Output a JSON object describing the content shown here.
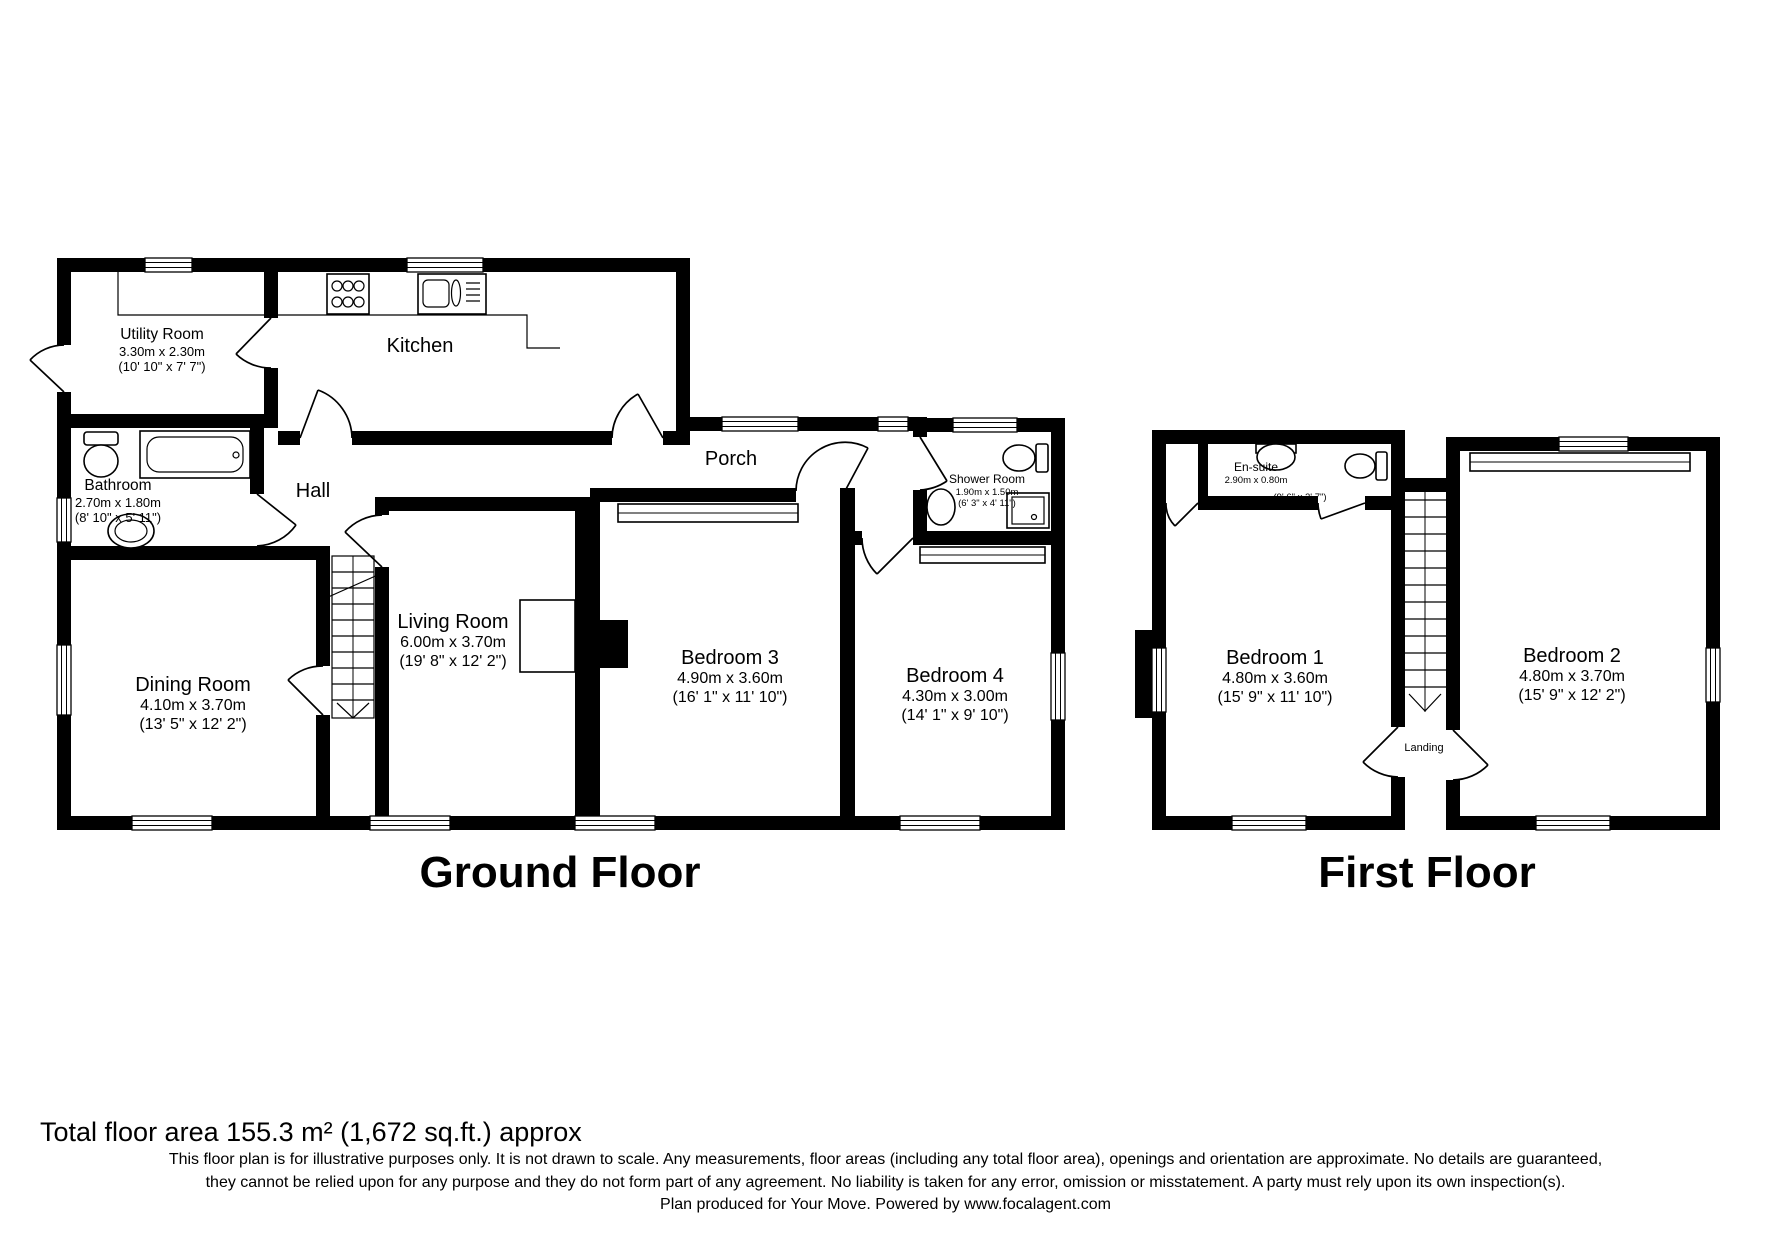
{
  "colors": {
    "wall": "#000000",
    "background": "#ffffff"
  },
  "ground_floor": {
    "title": "Ground Floor",
    "rooms": [
      {
        "name": "Utility Room",
        "dims_m": "3.30m x 2.30m",
        "dims_ft": "(10' 10\" x 7' 7\")"
      },
      {
        "name": "Kitchen"
      },
      {
        "name": "Bathroom",
        "dims_m": "2.70m x 1.80m",
        "dims_ft": "(8' 10\" x 5' 11\")"
      },
      {
        "name": "Hall"
      },
      {
        "name": "Porch"
      },
      {
        "name": "Shower Room",
        "dims_m": "1.90m x 1.50m",
        "dims_ft": "(6' 3\" x 4' 11\")"
      },
      {
        "name": "Dining Room",
        "dims_m": "4.10m x 3.70m",
        "dims_ft": "(13' 5\" x 12' 2\")"
      },
      {
        "name": "Living Room",
        "dims_m": "6.00m x 3.70m",
        "dims_ft": "(19' 8\" x 12' 2\")"
      },
      {
        "name": "Bedroom 3",
        "dims_m": "4.90m x 3.60m",
        "dims_ft": "(16' 1\" x 11' 10\")"
      },
      {
        "name": "Bedroom 4",
        "dims_m": "4.30m x 3.00m",
        "dims_ft": "(14' 1\" x 9' 10\")"
      }
    ]
  },
  "first_floor": {
    "title": "First Floor",
    "rooms": [
      {
        "name": "En-suite",
        "dims_m": "2.90m x 0.80m",
        "dims_ft": "(9' 6\" x 2' 7\")"
      },
      {
        "name": "Bedroom 1",
        "dims_m": "4.80m x 3.60m",
        "dims_ft": "(15' 9\" x 11' 10\")"
      },
      {
        "name": "Bedroom 2",
        "dims_m": "4.80m x 3.70m",
        "dims_ft": "(15' 9\" x 12' 2\")"
      },
      {
        "name": "Landing"
      }
    ]
  },
  "footer": {
    "total_area": "Total floor area 155.3 m² (1,672 sq.ft.) approx",
    "disclaimer_line1": "This floor plan is for illustrative purposes only. It is not drawn to scale. Any measurements, floor areas (including any total floor area), openings and orientation are approximate. No details are guaranteed,",
    "disclaimer_line2": "they cannot be relied upon for any purpose and they do not form part of any agreement. No liability is taken for any error, omission or misstatement. A party must rely upon its own inspection(s).",
    "disclaimer_line3": "Plan produced for Your Move. Powered by www.focalagent.com"
  }
}
